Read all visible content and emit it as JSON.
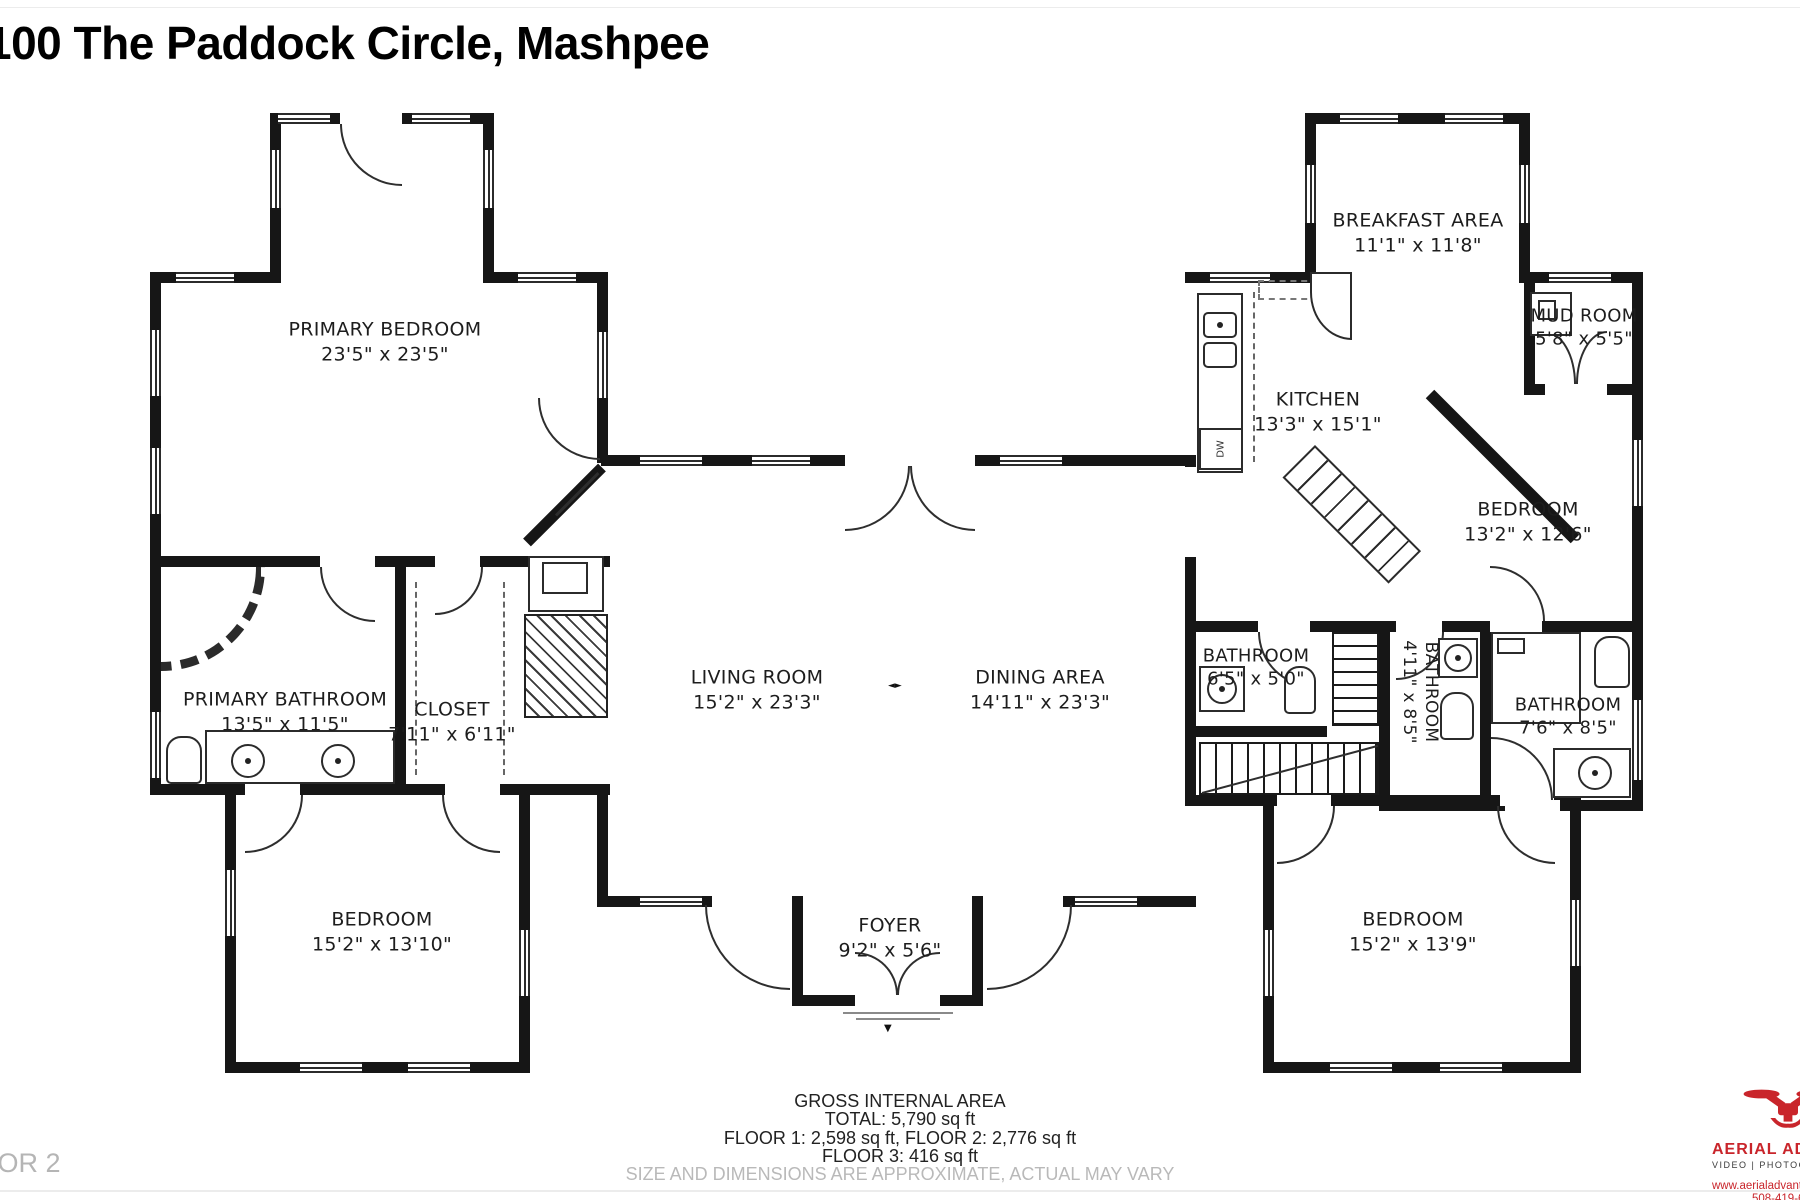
{
  "title": "100 The Paddock Circle, Mashpee",
  "floor_label": "FLOOR 2",
  "rooms": {
    "primary_bedroom": {
      "name": "PRIMARY BEDROOM",
      "dims": "23'5\" x 23'5\""
    },
    "primary_bathroom": {
      "name": "PRIMARY BATHROOM",
      "dims": "13'5\" x 11'5\""
    },
    "closet": {
      "name": "CLOSET",
      "dims": "7'11\" x 6'11\""
    },
    "bedroom_left": {
      "name": "BEDROOM",
      "dims": "15'2\" x 13'10\""
    },
    "living_room": {
      "name": "LIVING ROOM",
      "dims": "15'2\" x 23'3\""
    },
    "dining_area": {
      "name": "DINING AREA",
      "dims": "14'11\" x 23'3\""
    },
    "foyer": {
      "name": "FOYER",
      "dims": "9'2\" x 5'6\""
    },
    "breakfast_area": {
      "name": "BREAKFAST AREA",
      "dims": "11'1\" x 11'8\""
    },
    "mud_room": {
      "name": "MUD ROOM",
      "dims": "5'8\" x 5'5\""
    },
    "kitchen": {
      "name": "KITCHEN",
      "dims": "13'3\" x 15'1\""
    },
    "bedroom_right": {
      "name": "BEDROOM",
      "dims": "13'2\" x 12'6\""
    },
    "bathroom_small": {
      "name": "BATHROOM",
      "dims": "6'5\" x 5'0\""
    },
    "bathroom_mid": {
      "name": "BATHROOM",
      "dims": "4'11\" x 8'5\""
    },
    "bathroom_right": {
      "name": "BATHROOM",
      "dims": "7'6\" x 8'5\""
    },
    "bedroom_bottom_right": {
      "name": "BEDROOM",
      "dims": "15'2\" x 13'9\""
    }
  },
  "fixtures": {
    "dishwasher": "DW"
  },
  "footer": {
    "line1": "GROSS INTERNAL AREA",
    "line2": "TOTAL: 5,790 sq ft",
    "line3": "FLOOR 1: 2,598 sq ft, FLOOR 2: 2,776 sq ft",
    "line4": "FLOOR 3: 416 sq ft",
    "disclaimer": "SIZE AND DIMENSIONS ARE APPROXIMATE, ACTUAL MAY VARY"
  },
  "logo": {
    "brand": "AERIAL ADVANT",
    "sub": "VIDEO | PHOTOGRA",
    "web": "www.aerialadvantagecap",
    "phone": "508-419-6149"
  },
  "colors": {
    "wall": "#161616",
    "accent_red": "#c9252b",
    "gray_text": "#b5b5b5"
  }
}
